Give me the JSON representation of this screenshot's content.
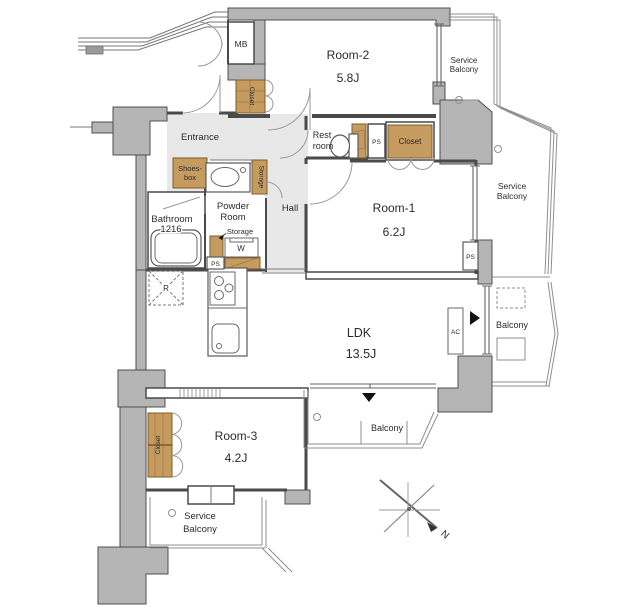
{
  "colors": {
    "wall": "#b5b5b5",
    "wallLine": "#4f4f4f",
    "line": "#4a4a4a",
    "closet": "#c59b60",
    "closetLine": "#7d5c28",
    "floor": "#e8e8e8",
    "balcony": "#8f8f8f",
    "text": "#2b2b2b",
    "marker": "#111111"
  },
  "rooms": {
    "ldk": {
      "name": "LDK",
      "size": "13.5J"
    },
    "room1": {
      "name": "Room-1",
      "size": "6.2J"
    },
    "room2": {
      "name": "Room-2",
      "size": "5.8J"
    },
    "room3": {
      "name": "Room-3",
      "size": "4.2J"
    },
    "entrance": {
      "name": "Entrance"
    },
    "hall": {
      "name": "Hall"
    },
    "powder_room": {
      "line1": "Powder",
      "line2": "Room"
    },
    "bathroom": {
      "line1": "Bathroom",
      "line2": "1216"
    },
    "rest_room": {
      "line1": "Rest",
      "line2": "room"
    }
  },
  "balconies": {
    "service": {
      "line1": "Service",
      "line2": "Balcony"
    },
    "main": "Balcony"
  },
  "fixtures": {
    "meter_box": "MB",
    "pipe_space": "PS",
    "closet": "Closet",
    "storage": "Storage",
    "shoes_box": {
      "line1": "Shoes-",
      "line2": "box"
    },
    "washer": "W",
    "refrigerator": "R",
    "air_conditioner": "AC",
    "north": "N"
  }
}
